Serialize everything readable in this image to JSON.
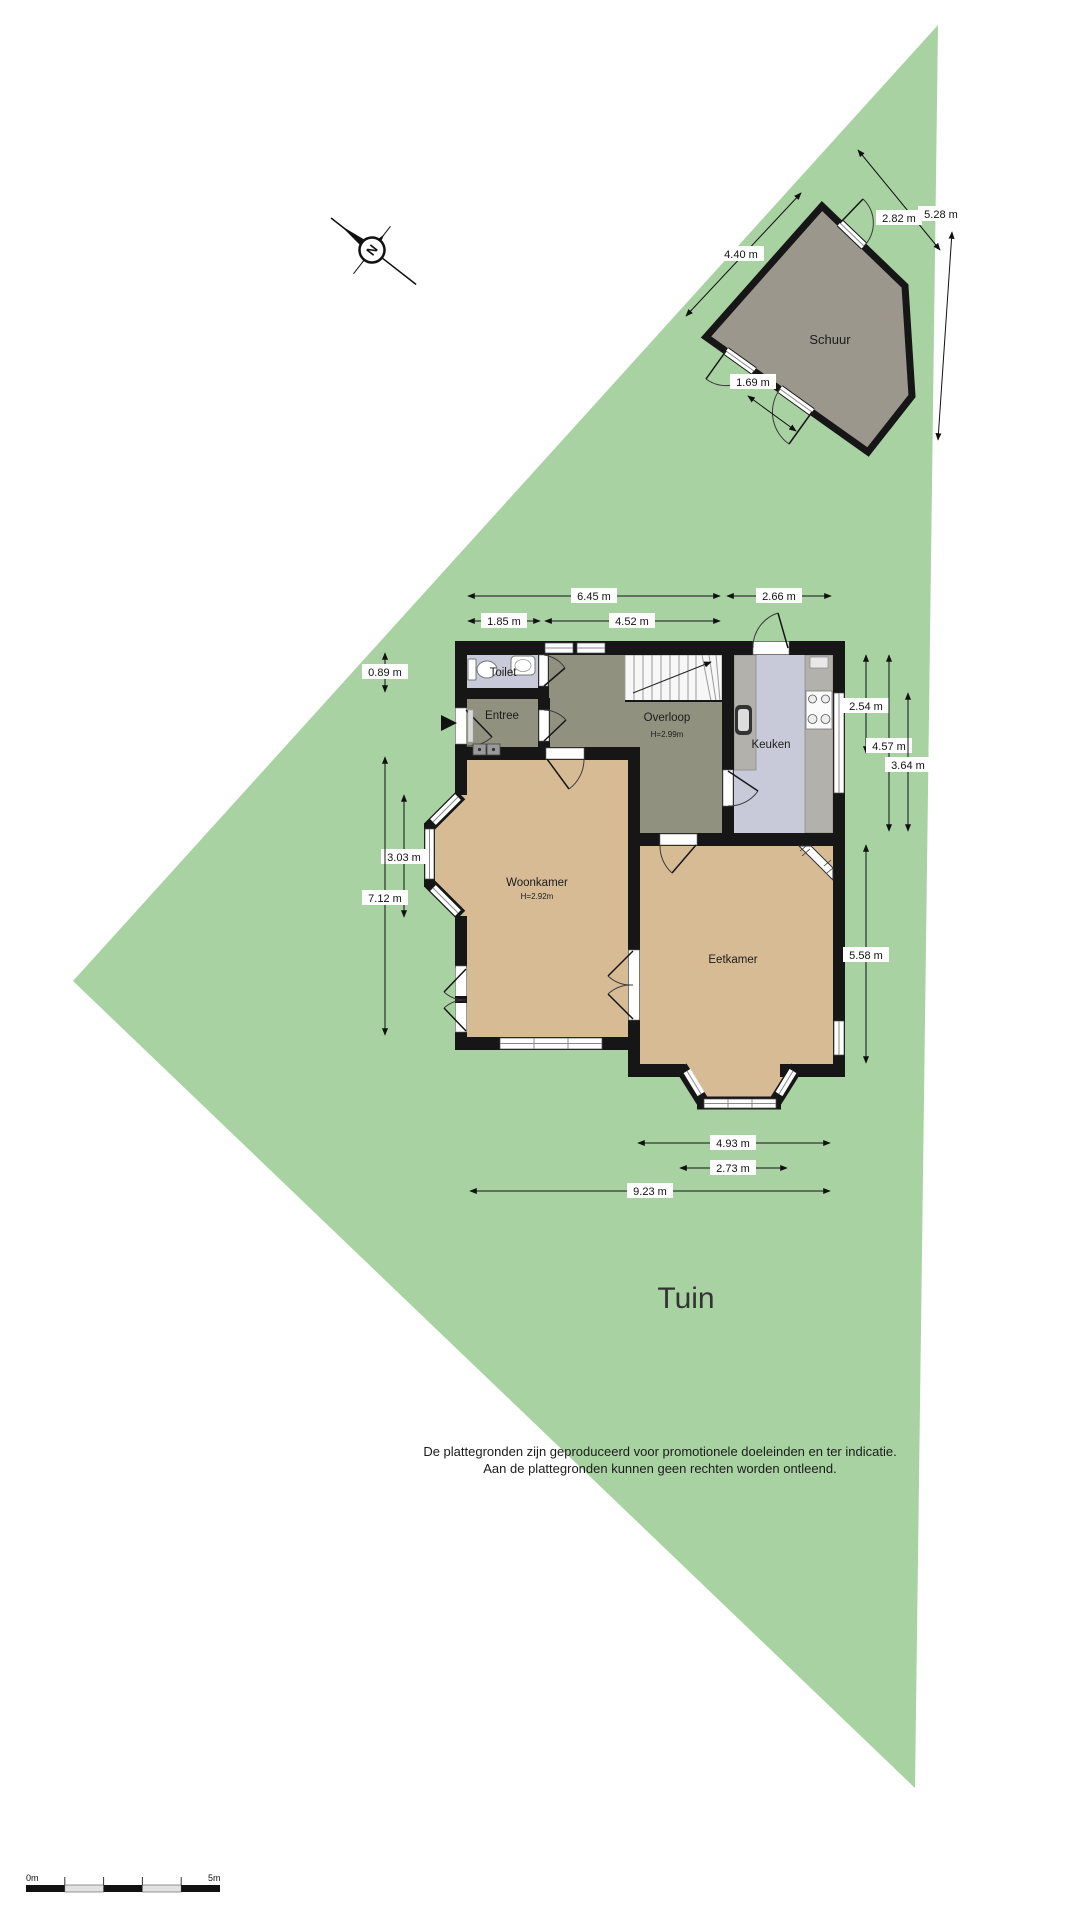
{
  "garden": {
    "label": "Tuin"
  },
  "shed": {
    "label": "Schuur"
  },
  "rooms": {
    "toilet": {
      "label": "Toilet"
    },
    "entree": {
      "label": "Entree"
    },
    "overloop": {
      "label": "Overloop",
      "ceiling": "H=2.99m"
    },
    "keuken": {
      "label": "Keuken"
    },
    "woonkamer": {
      "label": "Woonkamer",
      "ceiling": "H=2.92m"
    },
    "eetkamer": {
      "label": "Eetkamer"
    }
  },
  "dims": {
    "shed_side_left": "4.40 m",
    "shed_side_top": "2.82 m",
    "shed_side_right": "5.28 m",
    "shed_door": "1.69 m",
    "top_total": "6.45 m",
    "top_kitchen": "2.66 m",
    "top_toilet": "1.85 m",
    "top_inner": "4.52 m",
    "left_passage": "0.89 m",
    "left_bay": "3.03 m",
    "left_total": "7.12 m",
    "right_kitchen_window": "2.54 m",
    "right_kitchen_depth": "4.57 m",
    "right_inner": "3.64 m",
    "right_dining": "5.58 m",
    "bottom_dining": "4.93 m",
    "bottom_bay": "2.73 m",
    "bottom_total": "9.23 m"
  },
  "compass": {
    "label": "N"
  },
  "scale_bar": {
    "start": "0m",
    "end": "5m"
  },
  "disclaimer": {
    "line1": "De plattegronden zijn geproduceerd voor promotionele doeleinden en ter indicatie.",
    "line2": "Aan de plattegronden kunnen geen rechten worden ontleend."
  },
  "colors": {
    "garden": "#a8d2a2",
    "shed_floor": "#9b978c",
    "floor_wood": "#d7bb95",
    "floor_hall": "#90917f",
    "floor_tile": "#c8c9d9",
    "counter": "#b2b1ab",
    "wall": "#161616"
  }
}
